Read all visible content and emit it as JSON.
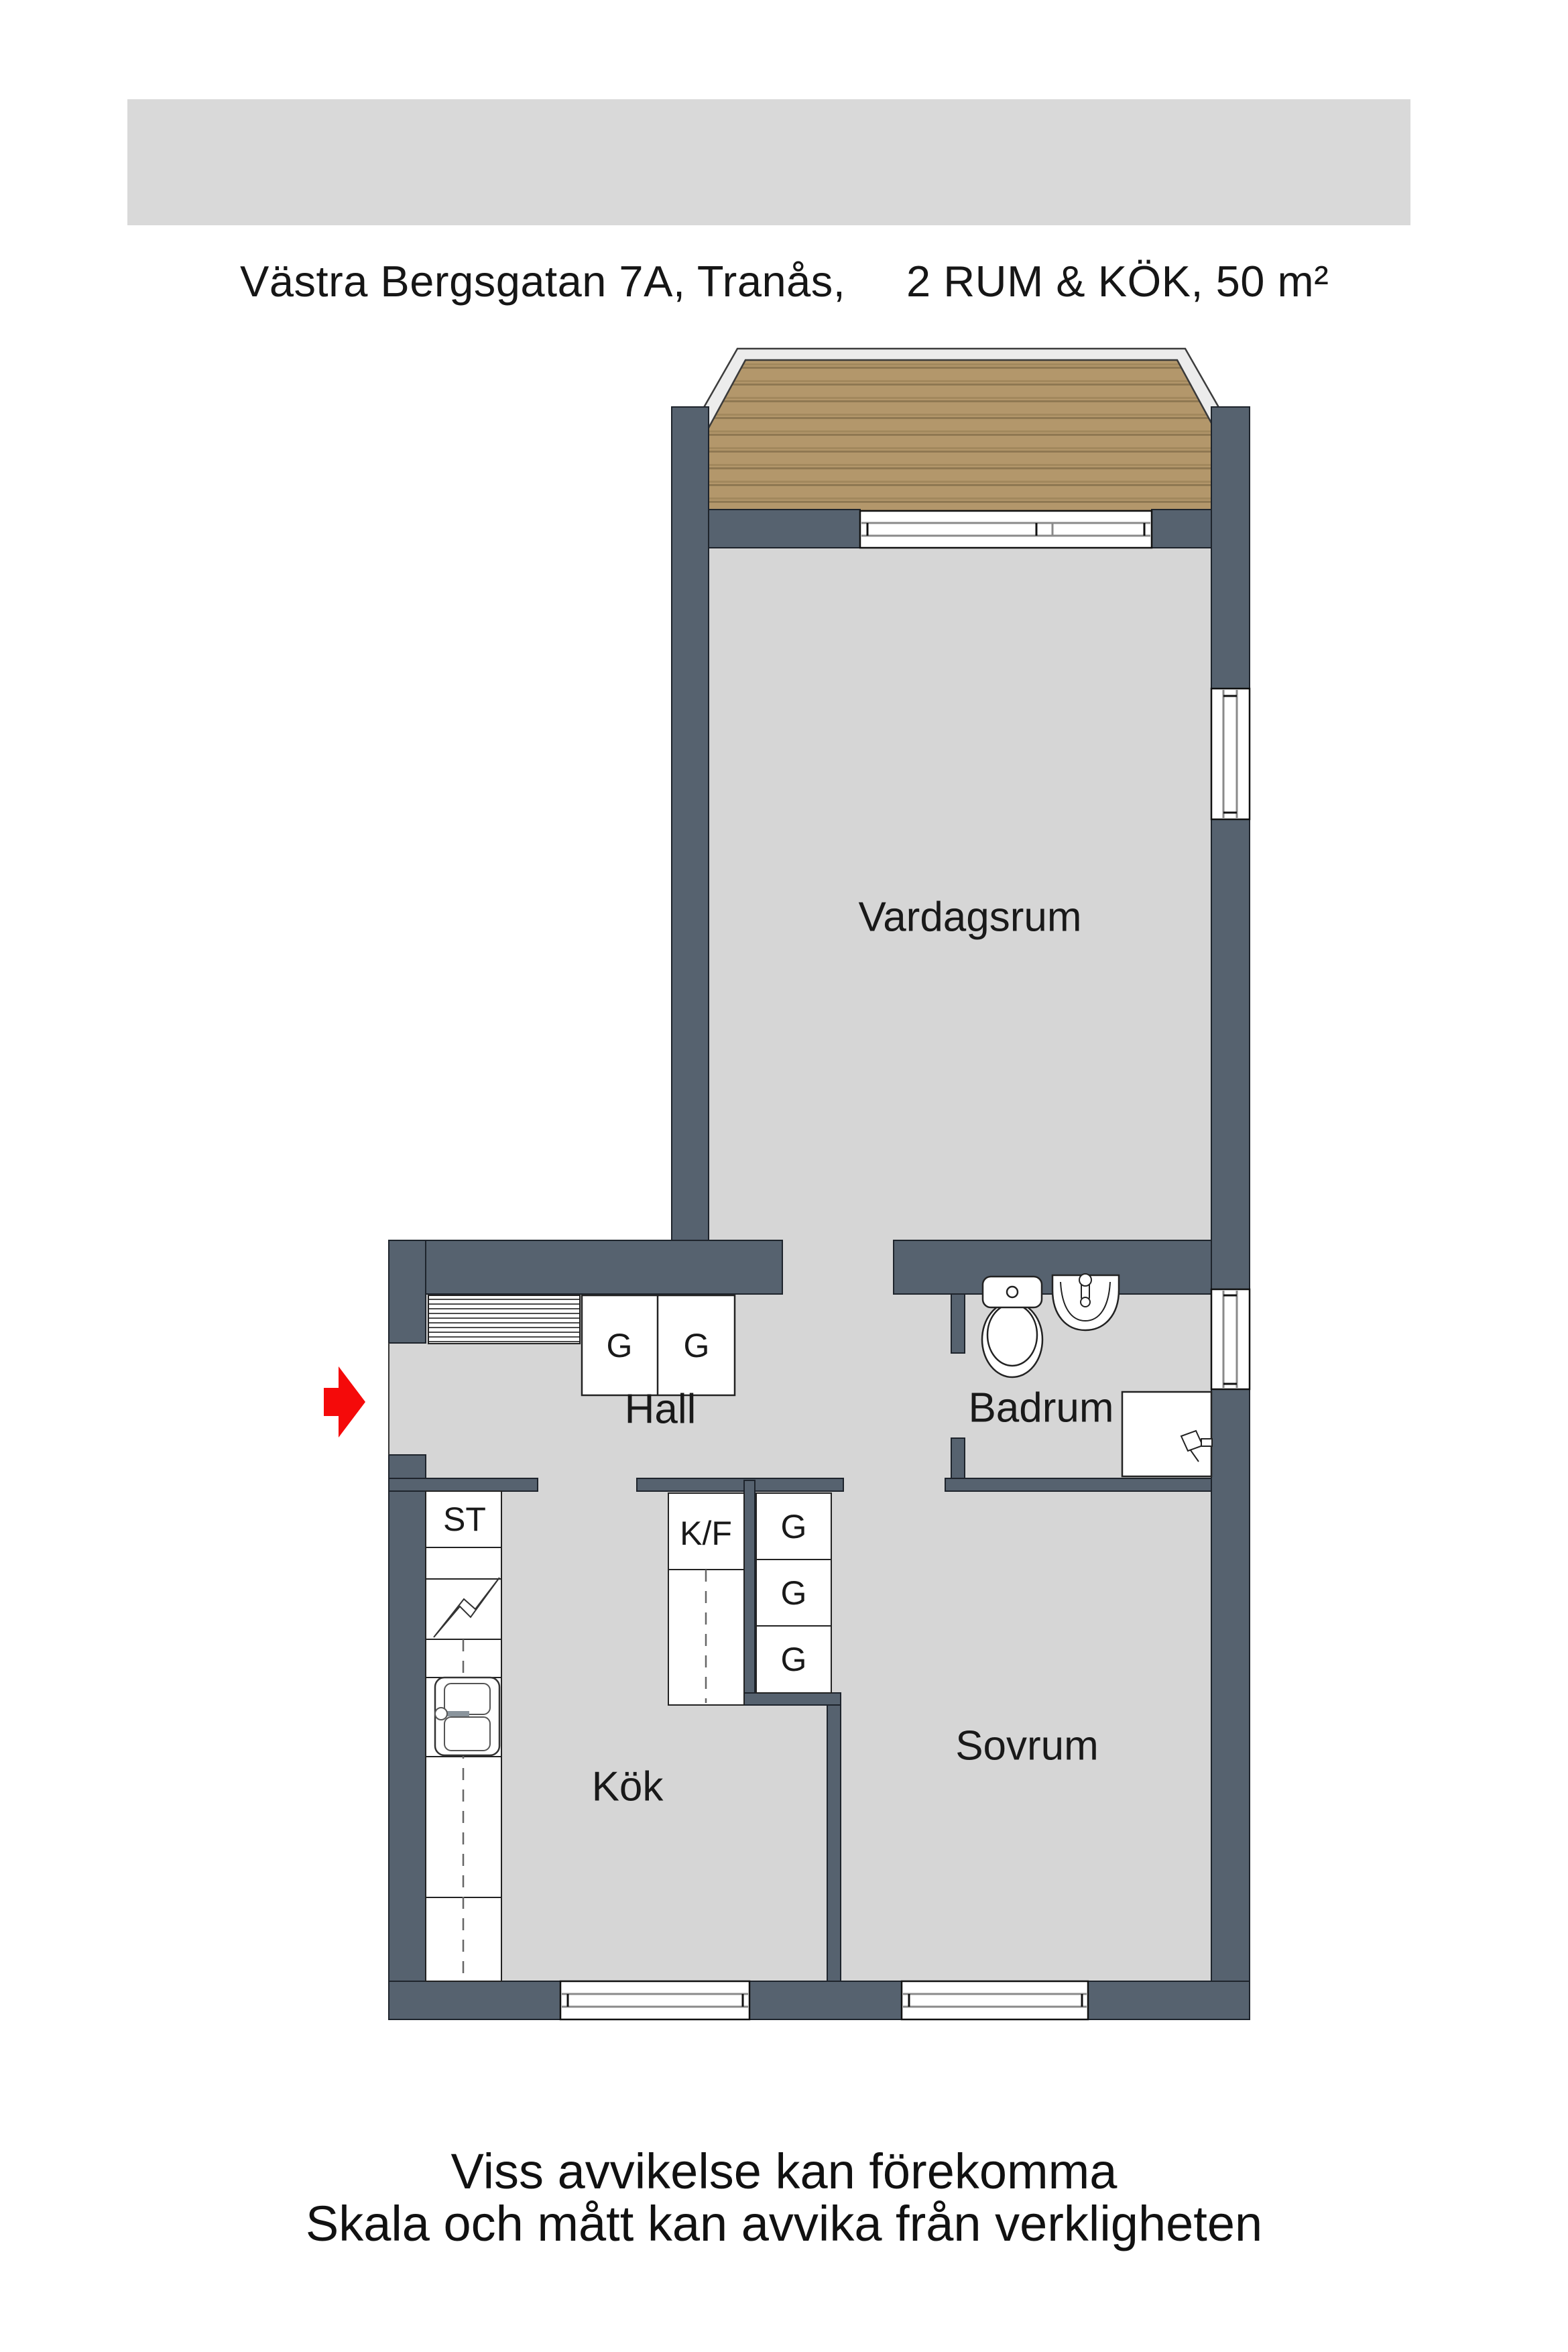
{
  "header": {
    "address": "Västra Bergsgatan 7A, Tranås,",
    "details": "2 RUM & KÖK, 50 m²"
  },
  "rooms": {
    "living": "Vardagsrum",
    "hall": "Hall",
    "bathroom": "Badrum",
    "kitchen": "Kök",
    "bedroom": "Sovrum"
  },
  "fixtures": {
    "closet": "ST",
    "fridge_freezer": "K/F",
    "wardrobe": "G"
  },
  "footer": {
    "line1": "Viss avvikelse kan förekomma",
    "line2": "Skala och mått kan avvika från verkligheten"
  },
  "colors": {
    "wall": "#56626F",
    "floor": "#D6D6D6",
    "wood": "#B3976B",
    "wood_line": "#8F7852",
    "railing": "#ECECEC",
    "header_bg": "#D9D9D9",
    "fixture_white": "#FFFFFF",
    "window_line": "#8A8A8A",
    "entrance_arrow_red": "#F50A0A"
  }
}
